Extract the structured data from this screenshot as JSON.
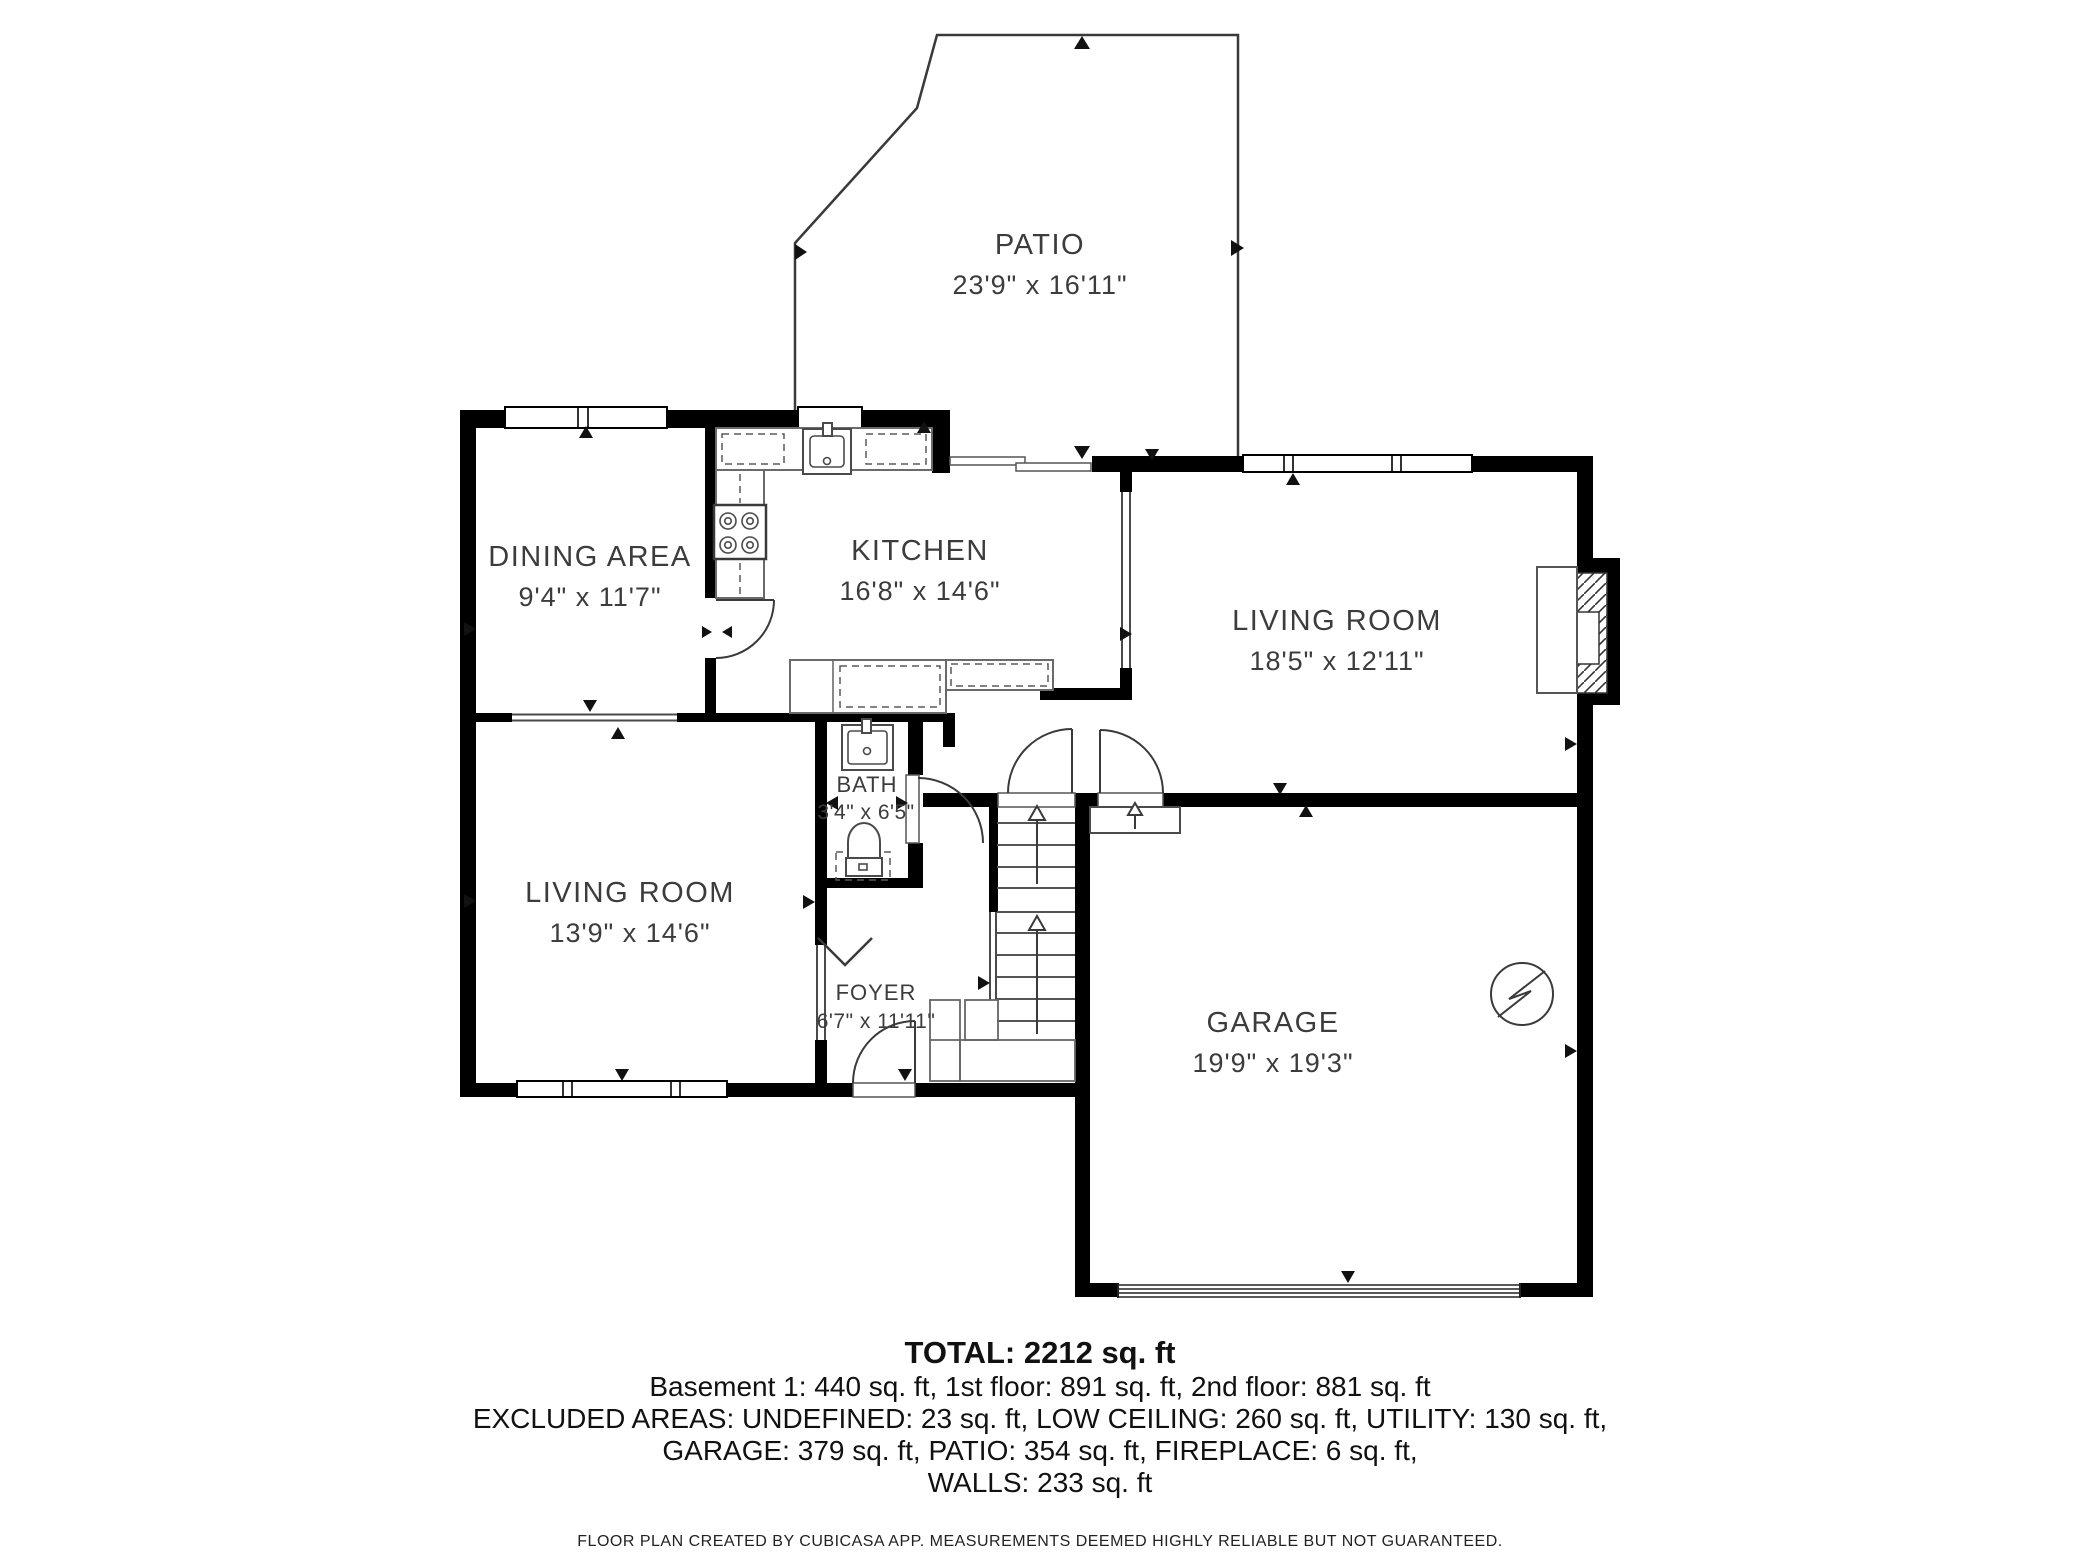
{
  "colors": {
    "walls": "#000000",
    "lines": "#3a3a3a",
    "fixtures": "#4a4a4a",
    "counters": "#6a6a6a",
    "label_text": "#3c3c3c",
    "summary_text": "#111111",
    "background": "#ffffff"
  },
  "rooms": [
    {
      "name": "PATIO",
      "dims": "23'9\" x 16'11\""
    },
    {
      "name": "DINING AREA",
      "dims": "9'4\" x 11'7\""
    },
    {
      "name": "KITCHEN",
      "dims": "16'8\" x 14'6\""
    },
    {
      "name": "LIVING ROOM",
      "dims": "18'5\" x 12'11\""
    },
    {
      "name": "BATH",
      "dims": "3'4\" x 6'5\""
    },
    {
      "name": "LIVING ROOM",
      "dims": "13'9\" x 14'6\""
    },
    {
      "name": "FOYER",
      "dims": "6'7\" x 11'11\""
    },
    {
      "name": "GARAGE",
      "dims": "19'9\" x 19'3\""
    }
  ],
  "icons": [
    {
      "name": "electrical-symbol",
      "location": "garage"
    },
    {
      "name": "fireplace-icon",
      "location": "living-room-right-wall"
    },
    {
      "name": "stairs-up-arrow-icon",
      "location": "staircase"
    },
    {
      "name": "step-up-arrow-icon",
      "location": "garage-entry"
    },
    {
      "name": "sink-icon",
      "location": "kitchen"
    },
    {
      "name": "stove-icon",
      "location": "kitchen"
    },
    {
      "name": "sink-icon",
      "location": "bath"
    },
    {
      "name": "toilet-icon",
      "location": "bath"
    }
  ],
  "summary": {
    "total": "TOTAL: 2212 sq. ft",
    "line1": "Basement 1: 440 sq. ft, 1st floor: 891 sq. ft, 2nd floor: 881 sq. ft",
    "line2": "EXCLUDED AREAS: UNDEFINED: 23 sq. ft, LOW CEILING: 260 sq. ft, UTILITY: 130 sq. ft,",
    "line3": "GARAGE: 379 sq. ft, PATIO: 354 sq. ft, FIREPLACE: 6 sq. ft,",
    "line4": "WALLS: 233 sq. ft",
    "disclaimer": "FLOOR PLAN CREATED BY CUBICASA APP. MEASUREMENTS DEEMED HIGHLY RELIABLE BUT NOT GUARANTEED."
  }
}
